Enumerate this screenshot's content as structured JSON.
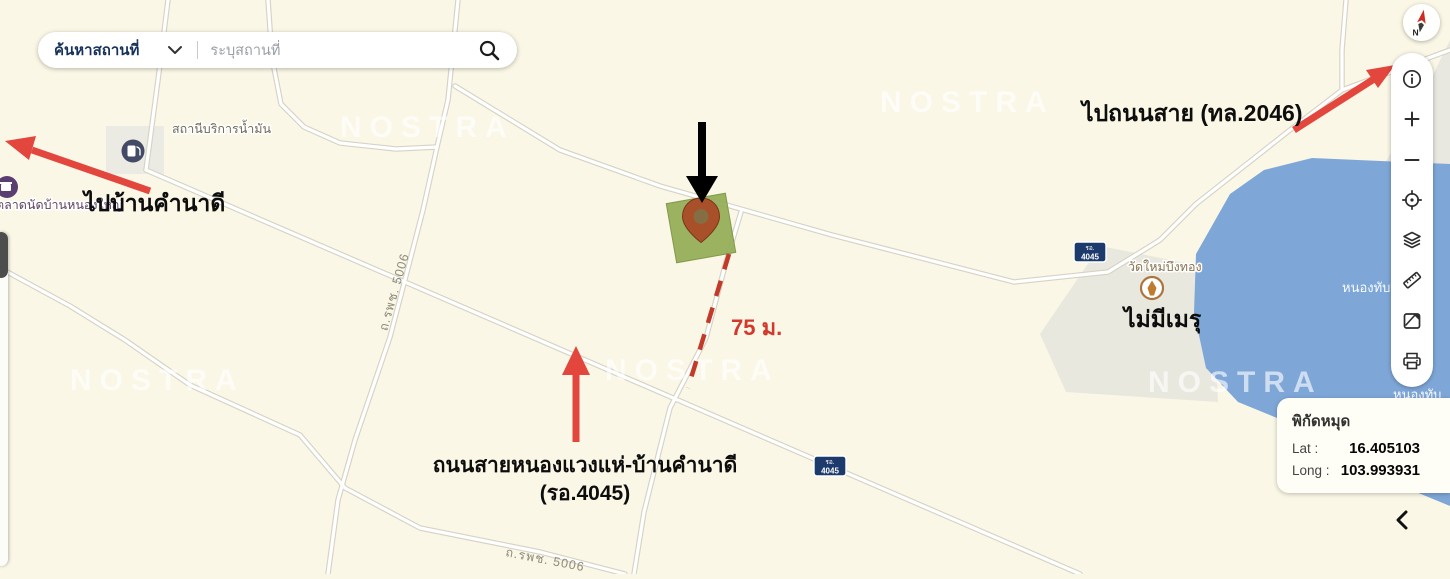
{
  "app": {
    "watermark": "NOSTRA"
  },
  "colors": {
    "background": "#faf7e6",
    "water": "#7ea7d8",
    "parcel_green": "#93ab56",
    "annotation_red": "#e2463c",
    "shield_navy": "#1c3a6b",
    "road_casing": "#d6d3c6"
  },
  "search_bar": {
    "category": "ค้นหาสถานที่",
    "placeholder": "ระบุสถานที่"
  },
  "compass": {
    "north_label": "N"
  },
  "toolbar": {
    "icons": [
      "info",
      "zoom-in",
      "zoom-out",
      "locate",
      "layers",
      "measure",
      "basemap",
      "print"
    ]
  },
  "map": {
    "pois": [
      {
        "type": "gas-station",
        "name": "สถานีบริการน้ำมัน"
      },
      {
        "type": "market",
        "name": "ตลาดนัดบ้านหนองใหญ่"
      },
      {
        "type": "temple",
        "name": "วัดใหม่บึงทอง"
      }
    ],
    "water_labels": [
      "หนองทับ",
      "หนองทับ"
    ],
    "road_labels": [
      "ถ.รพช. 5006",
      "ถ.รพช. 5006"
    ],
    "road_shields": [
      {
        "region": "รอ.",
        "number": "4045"
      },
      {
        "region": "รอ.",
        "number": "4045"
      }
    ]
  },
  "annotations": {
    "to_ban_khamnadi": "ไปบ้านคำนาดี",
    "to_highway_2046": "ไปถนนสาย (ทล.2046)",
    "no_crematorium": "ไม่มีเมรุ",
    "distance": "75 ม.",
    "road_name_line1": "ถนนสายหนองแวงแห่-บ้านคำนาดี",
    "road_name_line2": "(รอ.4045)"
  },
  "coords_panel": {
    "title": "พิกัดหมุด",
    "lat_label": "Lat :",
    "lat_value": "16.405103",
    "long_label": "Long :",
    "long_value": "103.993931"
  }
}
